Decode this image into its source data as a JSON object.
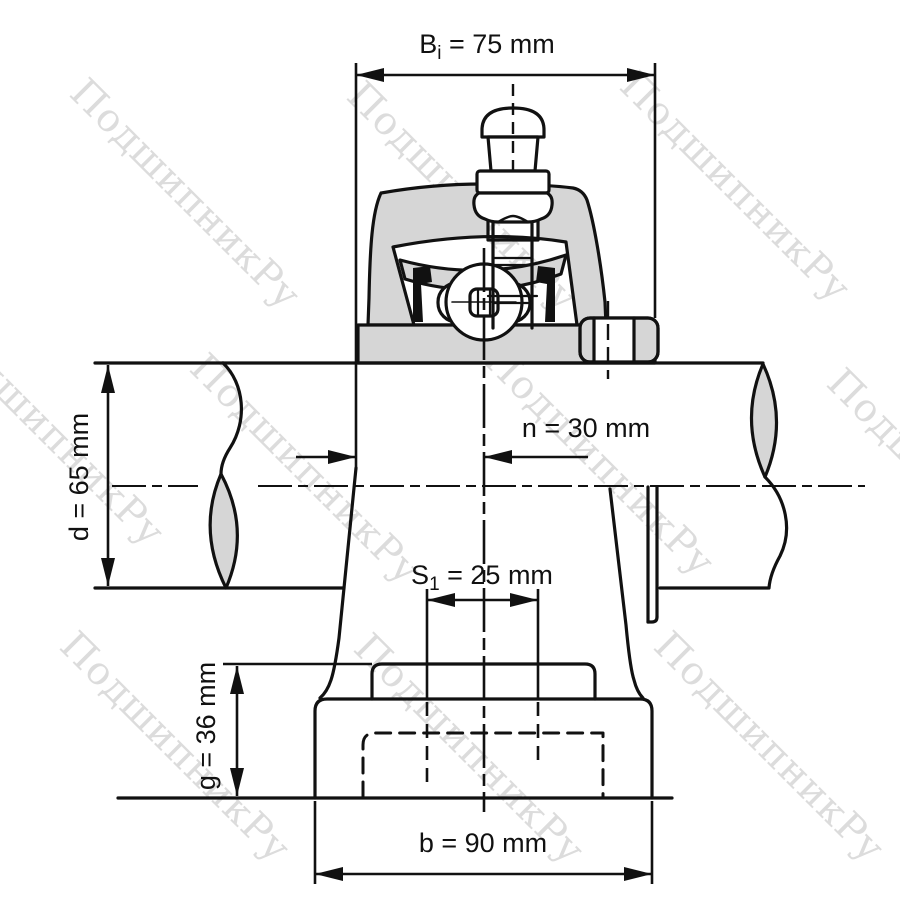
{
  "watermark": {
    "text": "ПодшипникРу",
    "color": "#dcdcdc"
  },
  "drawing": {
    "subject": "pillow-block bearing unit cross-section with dimensions",
    "colors": {
      "line": "#111111",
      "fill_gray": "#d6d6d6",
      "background": "#ffffff"
    },
    "dimensions": {
      "bi": {
        "base": "B",
        "sub": "i",
        "rest": " = 75 mm",
        "value_mm": 75
      },
      "n": {
        "text": "n = 30 mm",
        "value_mm": 30
      },
      "d": {
        "text": "d = 65 mm",
        "value_mm": 65
      },
      "s1": {
        "base": "S",
        "sub": "1",
        "rest": " = 25 mm",
        "value_mm": 25
      },
      "g": {
        "text": "g = 36 mm",
        "value_mm": 36
      },
      "b": {
        "text": "b = 90 mm",
        "value_mm": 90
      }
    }
  }
}
